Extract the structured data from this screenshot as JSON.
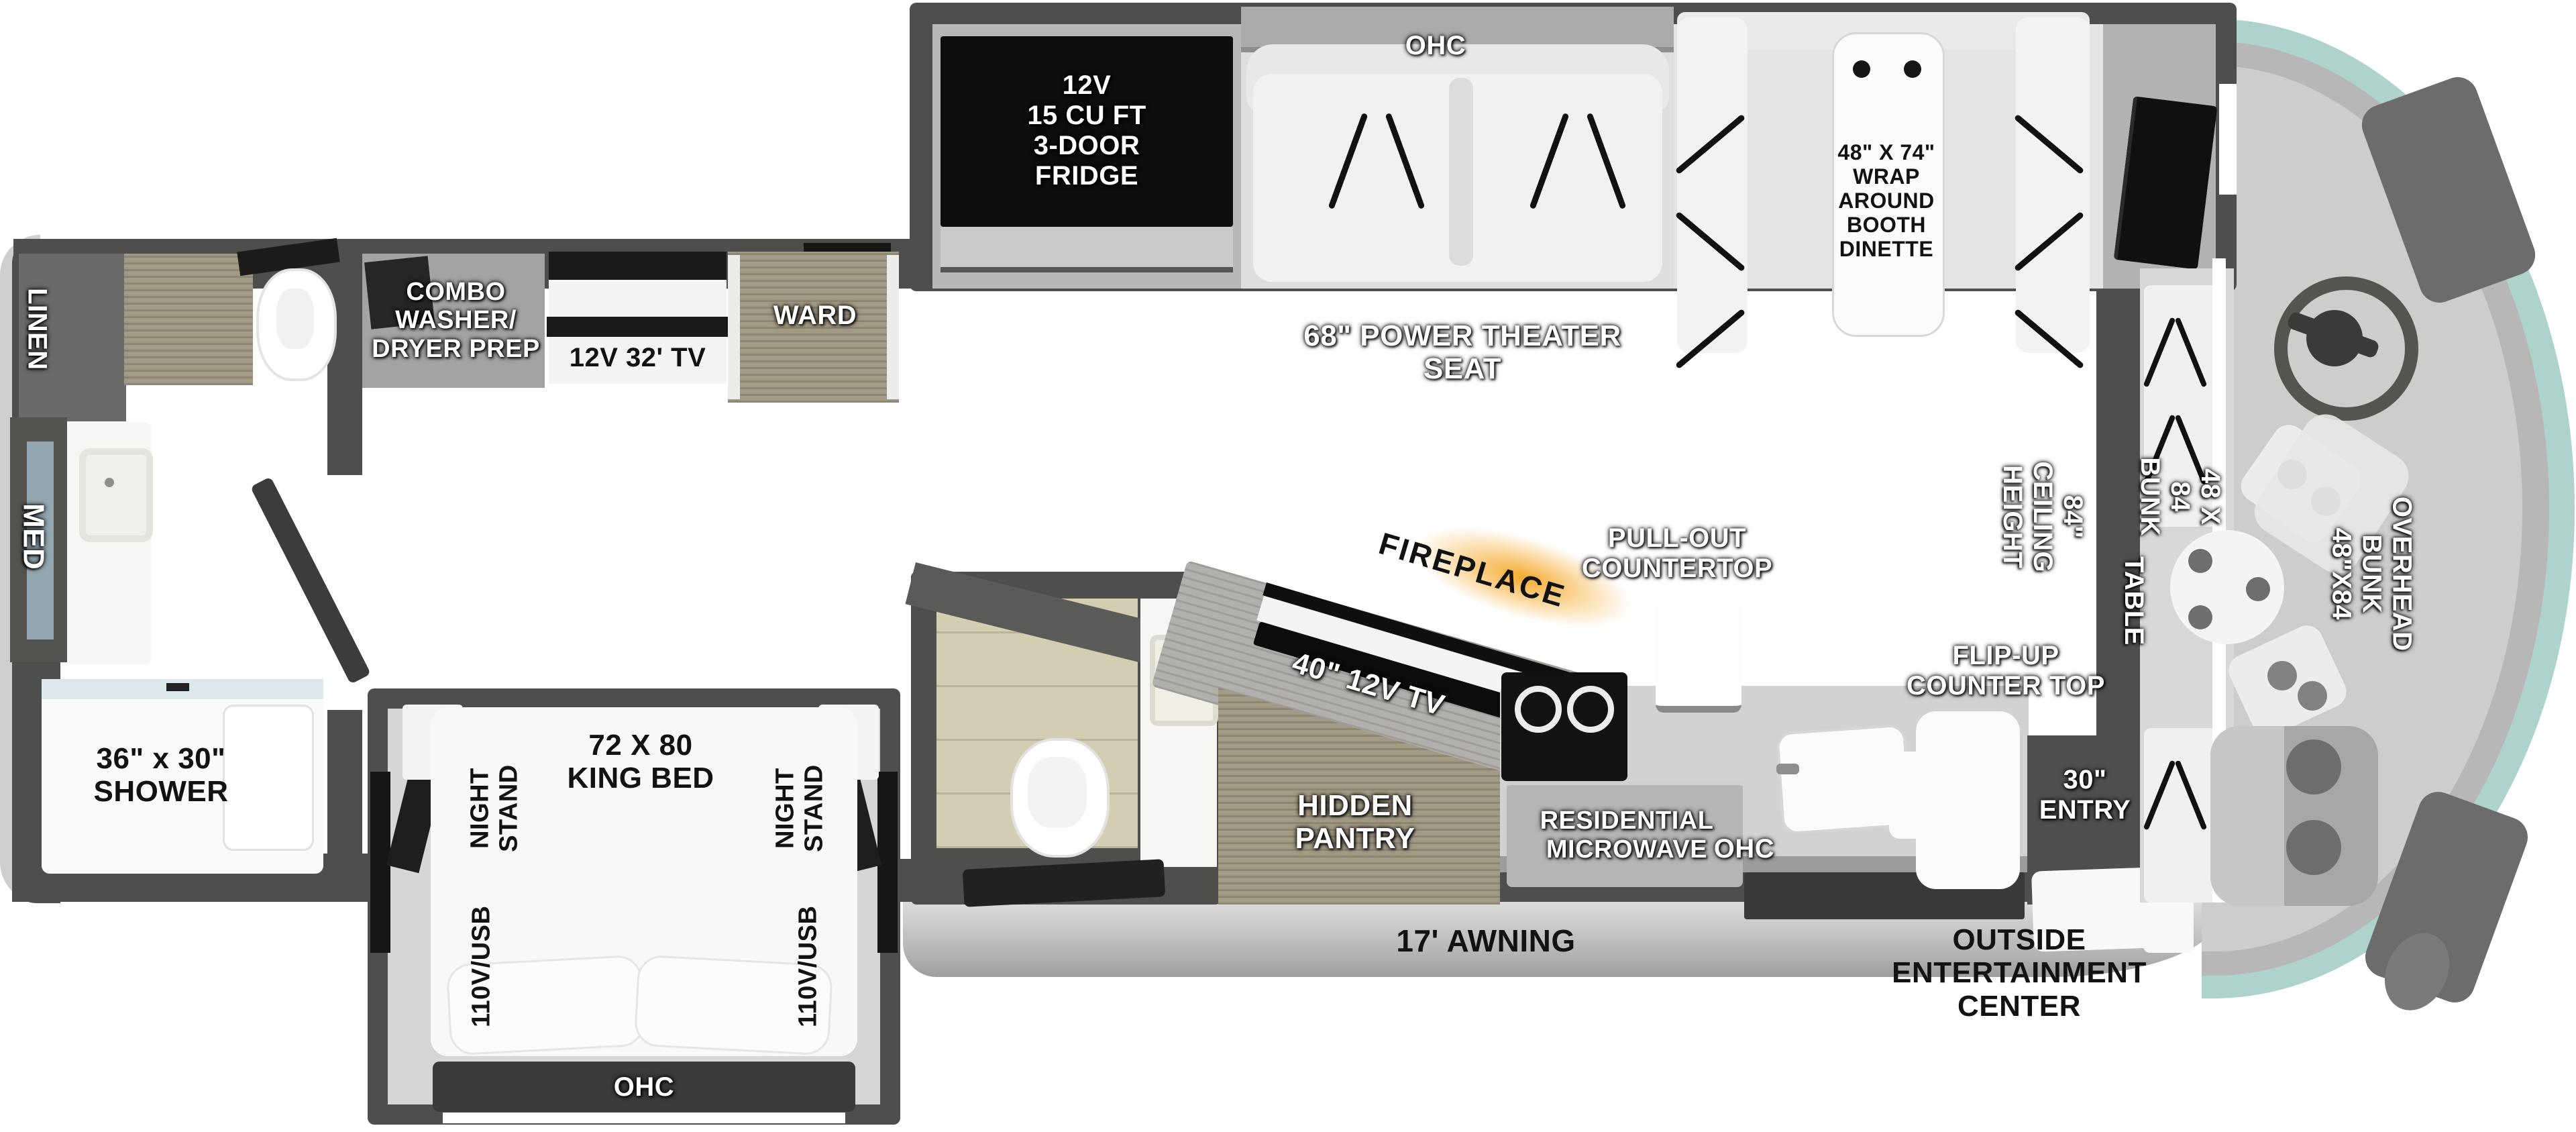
{
  "title": "RV floorplan diagram",
  "colors": {
    "wall": "#4e4e4c",
    "floor": "#cbc2a9",
    "wood": "#a39a86",
    "front_cap_teal": "#aed3cd",
    "fireplace_glow": "#f5a623",
    "appliance_black": "#141414"
  },
  "labels": {
    "galley": {
      "ohc": "OHC",
      "fridge": "12V\n15 CU FT\n3-DOOR\nFRIDGE",
      "theater_seat": "68\" POWER THEATER\nSEAT",
      "dinette": "48\" X 74\"\nWRAP\nAROUND\nBOOTH\nDINETTE"
    },
    "rear_bath": {
      "linen": "LINEN",
      "med": "MED",
      "shower": "36\" x 30\"\nSHOWER"
    },
    "bedroom": {
      "washer_dryer": "COMBO\nWASHER/\nDRYER PREP",
      "tv": "12V 32' TV",
      "ward": "WARD",
      "king_bed": "72 X 80\nKING BED",
      "night_stand": "NIGHT\nSTAND",
      "outlet": "110V/USB",
      "ohc": "OHC"
    },
    "kitchen": {
      "pull_out": "PULL-OUT\nCOUNTERTOP",
      "fireplace": "FIREPLACE",
      "tv": "40\" 12V TV",
      "hidden_pantry": "HIDDEN\nPANTRY",
      "microwave": "RESIDENTIAL\nMICROWAVE",
      "ohc": "OHC",
      "flip_up": "FLIP-UP\nCOUNTER TOP"
    },
    "entry": {
      "door": "30\"\nENTRY"
    },
    "front": {
      "ceiling": "84\" CEILING\nHEIGHT",
      "bunk": "48 X 84 BUNK",
      "table": "TABLE",
      "overhead_bunk": "OVERHEAD\nBUNK 48\"X84"
    },
    "exterior": {
      "awning": "17' AWNING",
      "entertainment": "OUTSIDE\nENTERTAINMENT\nCENTER"
    }
  }
}
